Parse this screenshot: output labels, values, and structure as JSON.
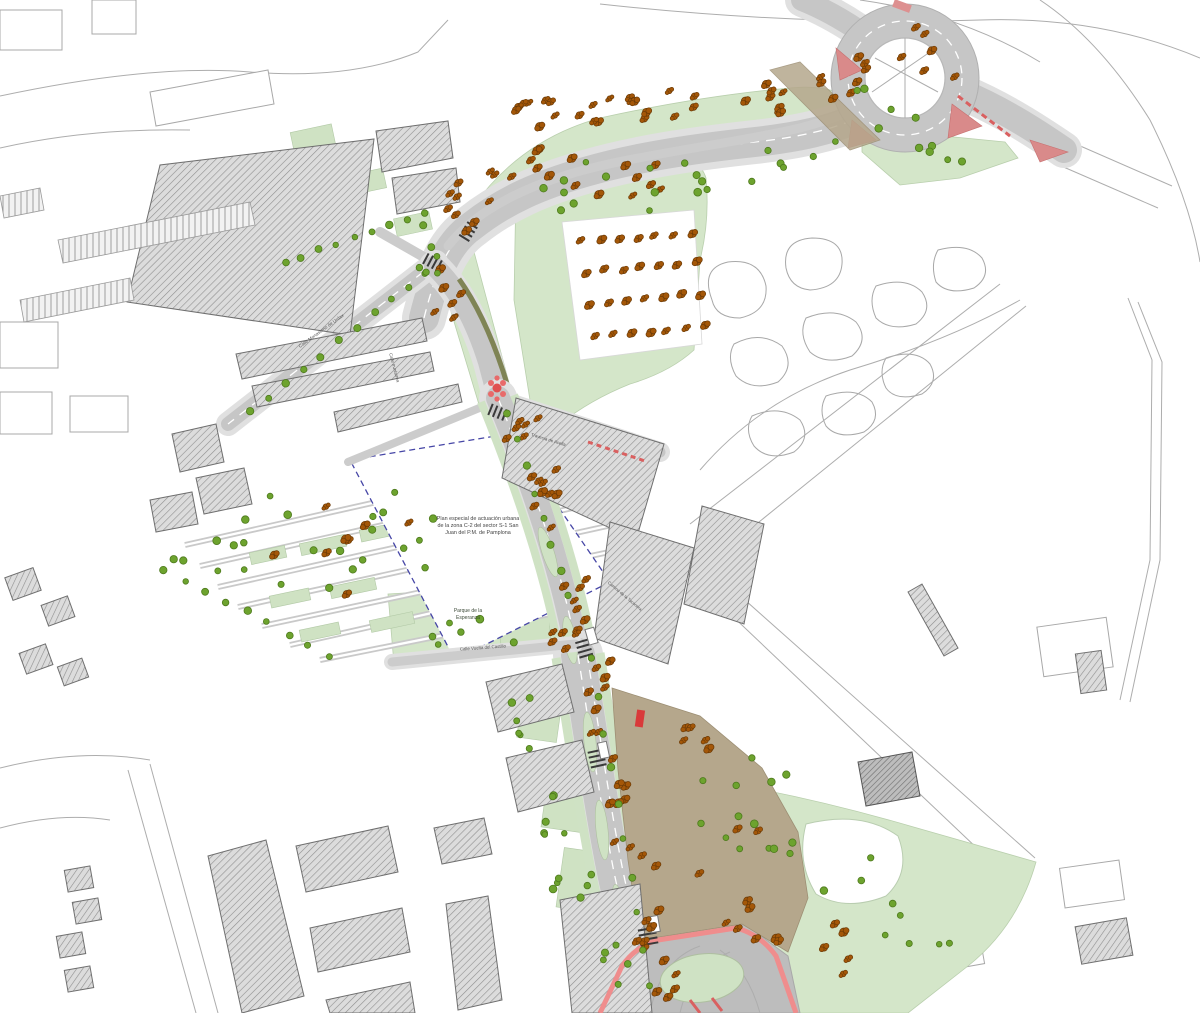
{
  "document": {
    "type": "urban-plan-drawing",
    "city": "Pamplona",
    "description": "Plano urbanístico CAD: viario, rotonda, parques, edificación rayada y arbolado"
  },
  "colors": {
    "road_gray": "#c6c6c6",
    "sidewalk_gray": "#e0e0e0",
    "green_area": "#d4e6c9",
    "tan_plaza": "#b5a78c",
    "building_hatch": "#8f8f8f",
    "tree_orange_fill": "#a45708",
    "tree_orange_stroke": "#6b3a06",
    "tree_green_fill": "#6da32e",
    "tree_green_stroke": "#4e7a1d",
    "boundary_blue": "#4646a6",
    "accent_red": "#d96060",
    "outline_pink": "#ef8d8d",
    "loading_yellow": "#e8c832"
  },
  "labels": [
    {
      "id": "parcel-note-1",
      "text": "Plan especial de actuación urbana",
      "x": 478,
      "y": 520,
      "rot": 0,
      "size": 5.4,
      "color": "#444444",
      "anchor": "middle"
    },
    {
      "id": "parcel-note-2",
      "text": "de la zona C-2 del sector S-1 San",
      "x": 478,
      "y": 527,
      "rot": 0,
      "size": 5.4,
      "color": "#444444",
      "anchor": "middle"
    },
    {
      "id": "parcel-note-3",
      "text": "Juan del P.M. de Pamplona",
      "x": 478,
      "y": 534,
      "rot": 0,
      "size": 5.4,
      "color": "#444444",
      "anchor": "middle"
    },
    {
      "id": "park-name-1",
      "text": "Parque de la",
      "x": 468,
      "y": 612,
      "rot": 0,
      "size": 5,
      "color": "#3c4a38",
      "anchor": "middle"
    },
    {
      "id": "park-name-2",
      "text": "Esperanza",
      "x": 468,
      "y": 619,
      "rot": 0,
      "size": 5,
      "color": "#3c4a38",
      "anchor": "middle"
    },
    {
      "id": "street-nw",
      "text": "Calle Monasterio de Urdax",
      "x": 322,
      "y": 332,
      "rot": -36,
      "size": 4.6,
      "color": "#555555",
      "anchor": "middle"
    },
    {
      "id": "street-vertical",
      "text": "Calle Irunlarrea",
      "x": 393,
      "y": 368,
      "rot": 75,
      "size": 4.4,
      "color": "#555555",
      "anchor": "middle"
    },
    {
      "id": "street-travesia",
      "text": "Travesía de Acella",
      "x": 548,
      "y": 441,
      "rot": 17,
      "size": 4.4,
      "color": "#555555",
      "anchor": "middle"
    },
    {
      "id": "street-park",
      "text": "Calle Vuelta del Castillo",
      "x": 483,
      "y": 649,
      "rot": -4,
      "size": 4.4,
      "color": "#555555",
      "anchor": "middle"
    },
    {
      "id": "camino",
      "text": "Camino de la Taconera",
      "x": 624,
      "y": 597,
      "rot": 40,
      "size": 4.2,
      "color": "#555555",
      "anchor": "middle"
    }
  ],
  "trees": {
    "clusters": [
      {
        "t": "o",
        "cx": 560,
        "cy": 115,
        "rx": 55,
        "ry": 22,
        "n": 12,
        "s": 11
      },
      {
        "t": "o",
        "cx": 655,
        "cy": 108,
        "rx": 55,
        "ry": 18,
        "n": 10,
        "s": 12
      },
      {
        "t": "o",
        "cx": 760,
        "cy": 100,
        "rx": 45,
        "ry": 16,
        "n": 8,
        "s": 13
      },
      {
        "t": "o",
        "cx": 835,
        "cy": 85,
        "rx": 25,
        "ry": 15,
        "n": 5,
        "s": 14
      },
      {
        "t": "o",
        "cx": 905,
        "cy": 70,
        "rx": 55,
        "ry": 45,
        "n": 9,
        "s": 15
      },
      {
        "t": "o",
        "cx": 480,
        "cy": 205,
        "rx": 40,
        "ry": 35,
        "n": 10,
        "s": 16
      },
      {
        "t": "o",
        "cx": 530,
        "cy": 165,
        "rx": 25,
        "ry": 18,
        "n": 6,
        "s": 17
      },
      {
        "t": "o",
        "cx": 620,
        "cy": 172,
        "rx": 60,
        "ry": 25,
        "n": 9,
        "s": 18
      },
      {
        "t": "o",
        "cx": 450,
        "cy": 300,
        "rx": 16,
        "ry": 50,
        "n": 7,
        "s": 19
      },
      {
        "t": "o",
        "cx": 520,
        "cy": 428,
        "rx": 22,
        "ry": 20,
        "n": 6,
        "s": 20
      },
      {
        "t": "o",
        "cx": 545,
        "cy": 505,
        "rx": 16,
        "ry": 55,
        "n": 9,
        "s": 21
      },
      {
        "t": "o",
        "cx": 575,
        "cy": 610,
        "rx": 18,
        "ry": 40,
        "n": 7,
        "s": 22
      },
      {
        "t": "o",
        "cx": 600,
        "cy": 700,
        "rx": 16,
        "ry": 50,
        "n": 8,
        "s": 23
      },
      {
        "t": "o",
        "cx": 622,
        "cy": 800,
        "rx": 14,
        "ry": 60,
        "n": 8,
        "s": 24
      },
      {
        "t": "o",
        "cx": 645,
        "cy": 900,
        "rx": 14,
        "ry": 55,
        "n": 8,
        "s": 25
      },
      {
        "t": "o",
        "cx": 660,
        "cy": 985,
        "rx": 20,
        "ry": 25,
        "n": 5,
        "s": 26
      },
      {
        "t": "o",
        "cx": 360,
        "cy": 545,
        "rx": 90,
        "ry": 50,
        "n": 8,
        "s": 27
      },
      {
        "t": "o",
        "cx": 740,
        "cy": 880,
        "rx": 45,
        "ry": 60,
        "n": 7,
        "s": 28
      },
      {
        "t": "o",
        "cx": 790,
        "cy": 950,
        "rx": 70,
        "ry": 40,
        "n": 8,
        "s": 29
      },
      {
        "t": "o",
        "cx": 560,
        "cy": 640,
        "rx": 25,
        "ry": 12,
        "n": 5,
        "s": 30
      },
      {
        "t": "o",
        "cx": 700,
        "cy": 730,
        "rx": 30,
        "ry": 20,
        "n": 5,
        "s": 31
      },
      {
        "t": "g",
        "cx": 600,
        "cy": 188,
        "rx": 120,
        "ry": 35,
        "n": 12,
        "s": 41
      },
      {
        "t": "g",
        "cx": 750,
        "cy": 172,
        "rx": 90,
        "ry": 25,
        "n": 8,
        "s": 42
      },
      {
        "t": "g",
        "cx": 880,
        "cy": 120,
        "rx": 60,
        "ry": 40,
        "n": 6,
        "s": 43
      },
      {
        "t": "g",
        "cx": 940,
        "cy": 160,
        "rx": 40,
        "ry": 15,
        "n": 5,
        "s": 44
      },
      {
        "t": "g",
        "cx": 432,
        "cy": 255,
        "rx": 14,
        "ry": 40,
        "n": 6,
        "s": 45
      },
      {
        "t": "g",
        "cx": 320,
        "cy": 548,
        "rx": 150,
        "ry": 70,
        "n": 24,
        "s": 46
      },
      {
        "t": "g",
        "cx": 470,
        "cy": 632,
        "rx": 60,
        "ry": 16,
        "n": 6,
        "s": 47
      },
      {
        "t": "g",
        "cx": 745,
        "cy": 825,
        "rx": 55,
        "ry": 80,
        "n": 14,
        "s": 48
      },
      {
        "t": "g",
        "cx": 900,
        "cy": 905,
        "rx": 80,
        "ry": 55,
        "n": 9,
        "s": 49
      },
      {
        "t": "g",
        "cx": 530,
        "cy": 715,
        "rx": 25,
        "ry": 35,
        "n": 6,
        "s": 50
      },
      {
        "t": "g",
        "cx": 555,
        "cy": 800,
        "rx": 25,
        "ry": 40,
        "n": 6,
        "s": 51
      },
      {
        "t": "g",
        "cx": 575,
        "cy": 880,
        "rx": 25,
        "ry": 40,
        "n": 6,
        "s": 52
      },
      {
        "t": "g",
        "cx": 610,
        "cy": 960,
        "rx": 20,
        "ry": 35,
        "n": 5,
        "s": 53
      }
    ],
    "rows": [
      {
        "t": "o",
        "x1": 582,
        "y1": 242,
        "x2": 692,
        "y2": 232,
        "n": 7,
        "s": 61
      },
      {
        "t": "o",
        "x1": 586,
        "y1": 272,
        "x2": 696,
        "y2": 262,
        "n": 7,
        "s": 62
      },
      {
        "t": "o",
        "x1": 590,
        "y1": 304,
        "x2": 700,
        "y2": 294,
        "n": 7,
        "s": 63
      },
      {
        "t": "o",
        "x1": 594,
        "y1": 336,
        "x2": 704,
        "y2": 326,
        "n": 7,
        "s": 64
      },
      {
        "t": "g",
        "x1": 250,
        "y1": 412,
        "x2": 428,
        "y2": 272,
        "n": 11,
        "s": 65
      },
      {
        "t": "g",
        "x1": 285,
        "y1": 262,
        "x2": 425,
        "y2": 215,
        "n": 9,
        "s": 66
      },
      {
        "t": "g",
        "x1": 508,
        "y1": 415,
        "x2": 568,
        "y2": 595,
        "n": 8,
        "s": 67
      },
      {
        "t": "g",
        "x1": 592,
        "y1": 660,
        "x2": 650,
        "y2": 985,
        "n": 10,
        "s": 68
      },
      {
        "t": "g",
        "x1": 165,
        "y1": 570,
        "x2": 330,
        "y2": 655,
        "n": 9,
        "s": 69
      }
    ]
  }
}
